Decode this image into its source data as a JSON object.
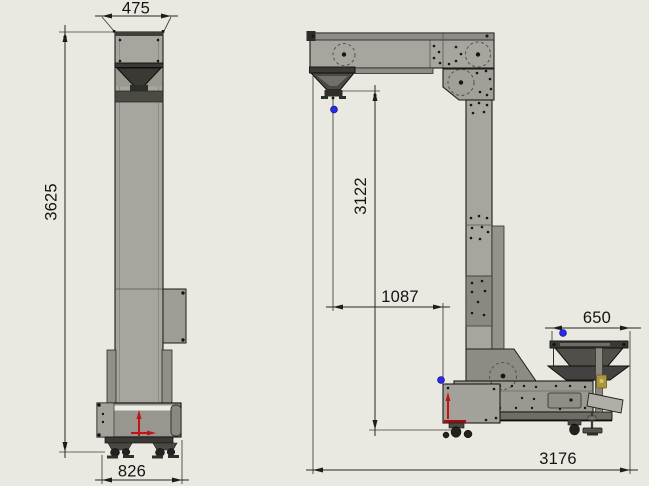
{
  "views": {
    "front": {
      "dims": {
        "top_width": "475",
        "overall_height": "3625",
        "base_width": "826"
      }
    },
    "side": {
      "dims": {
        "discharge_drop_height": "3122",
        "discharge_horizontal_offset": "1087",
        "infeed_hopper_width": "650",
        "overall_length": "3176"
      }
    }
  },
  "colors": {
    "background": "#eae9e1",
    "machine_body": "#a7a59e",
    "machine_dark": "#4a4945",
    "outline": "#1c1c1a",
    "dimension_line": "#262623",
    "text": "#131311",
    "point_marker_blue": "#2b2be0",
    "arrow_red": "#c21414",
    "bracket_gold": "#ab9640"
  }
}
